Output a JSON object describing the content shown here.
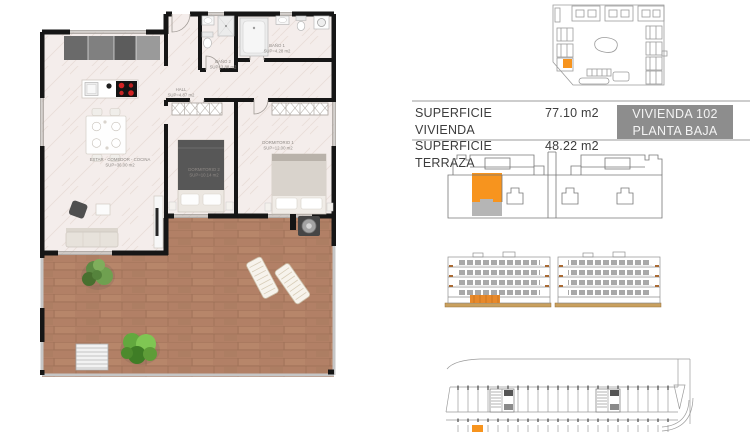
{
  "summary": {
    "rows": [
      {
        "label": "SUPERFICIE VIVIENDA",
        "value": "77.10 m2"
      },
      {
        "label": "SUPERFICIE TERRAZA",
        "value": "48.22 m2"
      }
    ],
    "unit_badge": {
      "line1": "VIVIENDA 102",
      "line2": "PLANTA BAJA"
    }
  },
  "floor_plan": {
    "rooms": [
      {
        "name": "ESTAR - COMEDOR - COCINA",
        "area": "SUP=36.00 m2"
      },
      {
        "name": "HALL",
        "area": "SUP=4.87 m2"
      },
      {
        "name": "BAÑO 2",
        "area": "SUP=3.88 m2"
      },
      {
        "name": "BAÑO 1",
        "area": "SUP=4.28 m2"
      },
      {
        "name": "DORMITORIO 2",
        "area": "SUP=10.14 m2"
      },
      {
        "name": "DORMITORIO 1",
        "area": "SUP=12.00 m2"
      }
    ]
  },
  "colors": {
    "accent_orange": "#F7941E",
    "badge_gray": "#8D8D8D",
    "wall_black": "#161616",
    "wood_floor": "#B28066",
    "marble_floor": "#F4EDEB",
    "line_gray": "#9B9B9B",
    "ground_tan": "#C9A05E"
  }
}
